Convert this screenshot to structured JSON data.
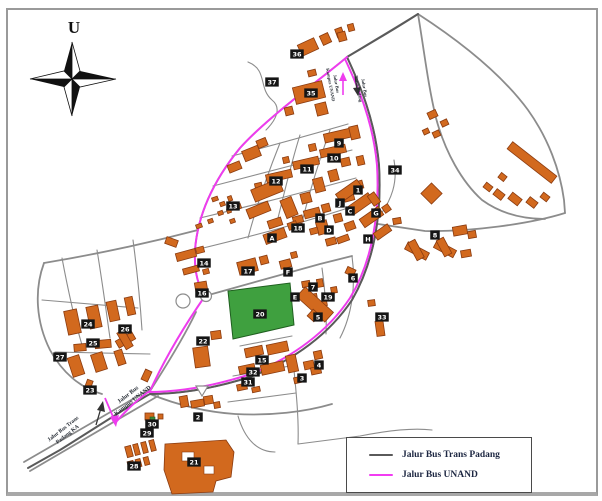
{
  "compass": {
    "label": "U"
  },
  "legend": {
    "items": [
      {
        "label": "Jalur Bus Trans Padang",
        "color": "#5a5a5a"
      },
      {
        "label": "Jalur Bus UNAND",
        "color": "#f23cf2"
      }
    ]
  },
  "routes": {
    "trans_padang_color": "#5a5a5a",
    "unand_color": "#ee3cee"
  },
  "map": {
    "road_labels": [
      {
        "lines": [
          "Jalur Bus",
          "Kampus UNAND"
        ],
        "x": 129,
        "y": 396,
        "rotate": -38,
        "size": 6
      },
      {
        "lines": [
          "Jalur Bus Trans",
          "Padang KA"
        ],
        "x": 64,
        "y": 430,
        "rotate": -38,
        "size": 5.5
      },
      {
        "lines": [
          "Jalur Bus",
          "Kampus UNAND"
        ],
        "x": 335,
        "y": 84,
        "rotate": 80,
        "size": 4.5
      },
      {
        "lines": [
          "Jalur Bus",
          "Trans Padang"
        ],
        "x": 363,
        "y": 88,
        "rotate": 80,
        "size": 4.5
      }
    ],
    "building_labels": [
      {
        "id": "36",
        "x": 297,
        "y": 54
      },
      {
        "id": "37",
        "x": 272,
        "y": 82
      },
      {
        "id": "35",
        "x": 311,
        "y": 93
      },
      {
        "id": "9",
        "x": 339,
        "y": 143
      },
      {
        "id": "10",
        "x": 334,
        "y": 158
      },
      {
        "id": "11",
        "x": 307,
        "y": 169
      },
      {
        "id": "12",
        "x": 276,
        "y": 181
      },
      {
        "id": "34",
        "x": 395,
        "y": 170
      },
      {
        "id": "13",
        "x": 233,
        "y": 206
      },
      {
        "id": "14",
        "x": 204,
        "y": 263
      },
      {
        "id": "1",
        "x": 358,
        "y": 190
      },
      {
        "id": "J",
        "x": 340,
        "y": 203
      },
      {
        "id": "C",
        "x": 350,
        "y": 211
      },
      {
        "id": "G",
        "x": 376,
        "y": 213
      },
      {
        "id": "H",
        "x": 368,
        "y": 239
      },
      {
        "id": "B",
        "x": 320,
        "y": 218
      },
      {
        "id": "D",
        "x": 329,
        "y": 230
      },
      {
        "id": "A",
        "x": 272,
        "y": 238
      },
      {
        "id": "F",
        "x": 288,
        "y": 272
      },
      {
        "id": "E",
        "x": 295,
        "y": 297
      },
      {
        "id": "8",
        "x": 435,
        "y": 235
      },
      {
        "id": "18",
        "x": 298,
        "y": 228
      },
      {
        "id": "17",
        "x": 248,
        "y": 271
      },
      {
        "id": "7",
        "x": 313,
        "y": 287
      },
      {
        "id": "19",
        "x": 328,
        "y": 297
      },
      {
        "id": "6",
        "x": 353,
        "y": 278
      },
      {
        "id": "5",
        "x": 318,
        "y": 317
      },
      {
        "id": "33",
        "x": 382,
        "y": 317
      },
      {
        "id": "16",
        "x": 202,
        "y": 293
      },
      {
        "id": "20",
        "x": 260,
        "y": 314
      },
      {
        "id": "22",
        "x": 203,
        "y": 341
      },
      {
        "id": "15",
        "x": 262,
        "y": 360
      },
      {
        "id": "32",
        "x": 253,
        "y": 372
      },
      {
        "id": "31",
        "x": 248,
        "y": 382
      },
      {
        "id": "4",
        "x": 319,
        "y": 365
      },
      {
        "id": "3",
        "x": 302,
        "y": 378
      },
      {
        "id": "24",
        "x": 88,
        "y": 324
      },
      {
        "id": "26",
        "x": 125,
        "y": 329
      },
      {
        "id": "25",
        "x": 93,
        "y": 343
      },
      {
        "id": "27",
        "x": 60,
        "y": 357
      },
      {
        "id": "23",
        "x": 90,
        "y": 390
      },
      {
        "id": "30",
        "x": 152,
        "y": 424
      },
      {
        "id": "29",
        "x": 147,
        "y": 433
      },
      {
        "id": "2",
        "x": 198,
        "y": 417
      },
      {
        "id": "28",
        "x": 134,
        "y": 466
      },
      {
        "id": "21",
        "x": 194,
        "y": 462
      }
    ]
  }
}
